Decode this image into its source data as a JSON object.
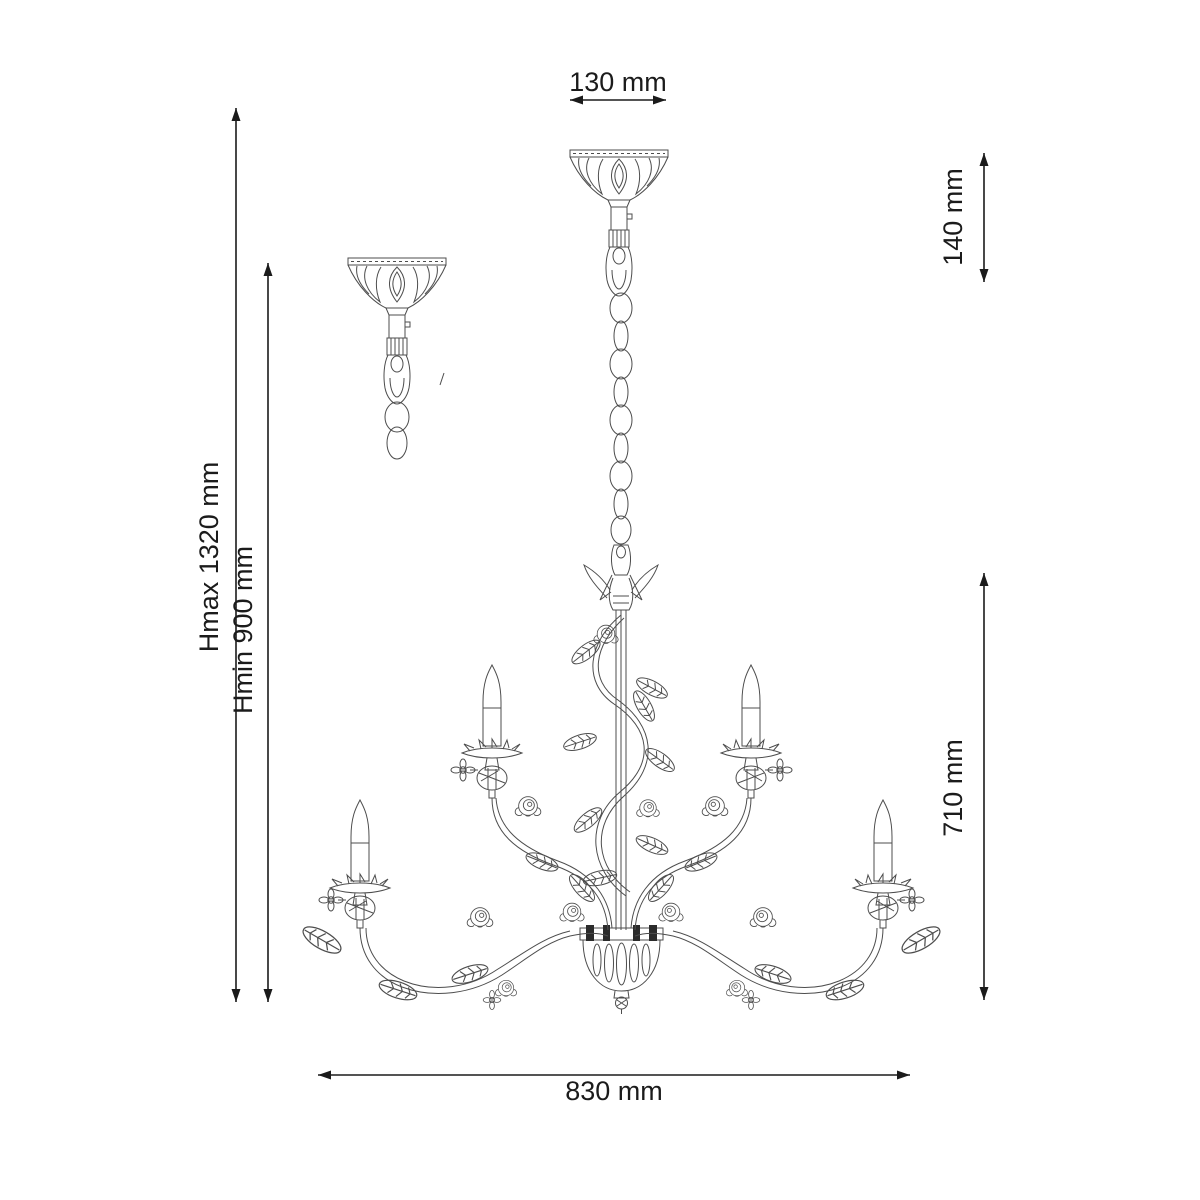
{
  "diagram": {
    "type": "technical-dimension-drawing",
    "subject": "chandelier 5-arm floral line drawing with ceiling canopy detail",
    "dimensions": {
      "top_width": "130 mm",
      "canopy_chain_length": "140 mm",
      "height_max": "Hmax 1320 mm",
      "height_min": "Hmin 900 mm",
      "body_height": "710 mm",
      "body_width": "830 mm"
    }
  }
}
